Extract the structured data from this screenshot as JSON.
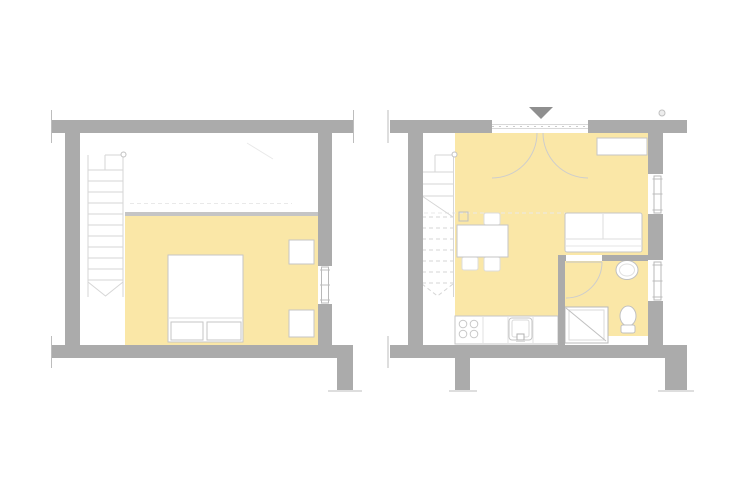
{
  "colors": {
    "background": "#ffffff",
    "wall": "#ababab",
    "wall_accent": "#8f8f8f",
    "floor": "#fae7a7",
    "loft_edge": "#c5c5c5",
    "furniture_edge": "#c6c6c6",
    "line": "#d6d6d6",
    "faint_line": "#e9e9e9"
  },
  "plans": {
    "left": {
      "name": "upper-level-floor-plan",
      "components": [
        "staircase-with-down-arrow",
        "loft-floor-edge",
        "double-bed",
        "pillow",
        "pillow",
        "nightstand",
        "nightstand",
        "window"
      ]
    },
    "right": {
      "name": "main-level-floor-plan",
      "components": [
        "entrance-triangle-marker",
        "entrance-double-door",
        "staircase-with-cut-line",
        "dining-table",
        "chair",
        "chair",
        "chair",
        "sofa",
        "sideboard",
        "kitchen-counter",
        "stove-burners",
        "kitchen-sink",
        "bathroom-door",
        "washbasin",
        "toilet",
        "shower",
        "window",
        "window"
      ]
    }
  }
}
